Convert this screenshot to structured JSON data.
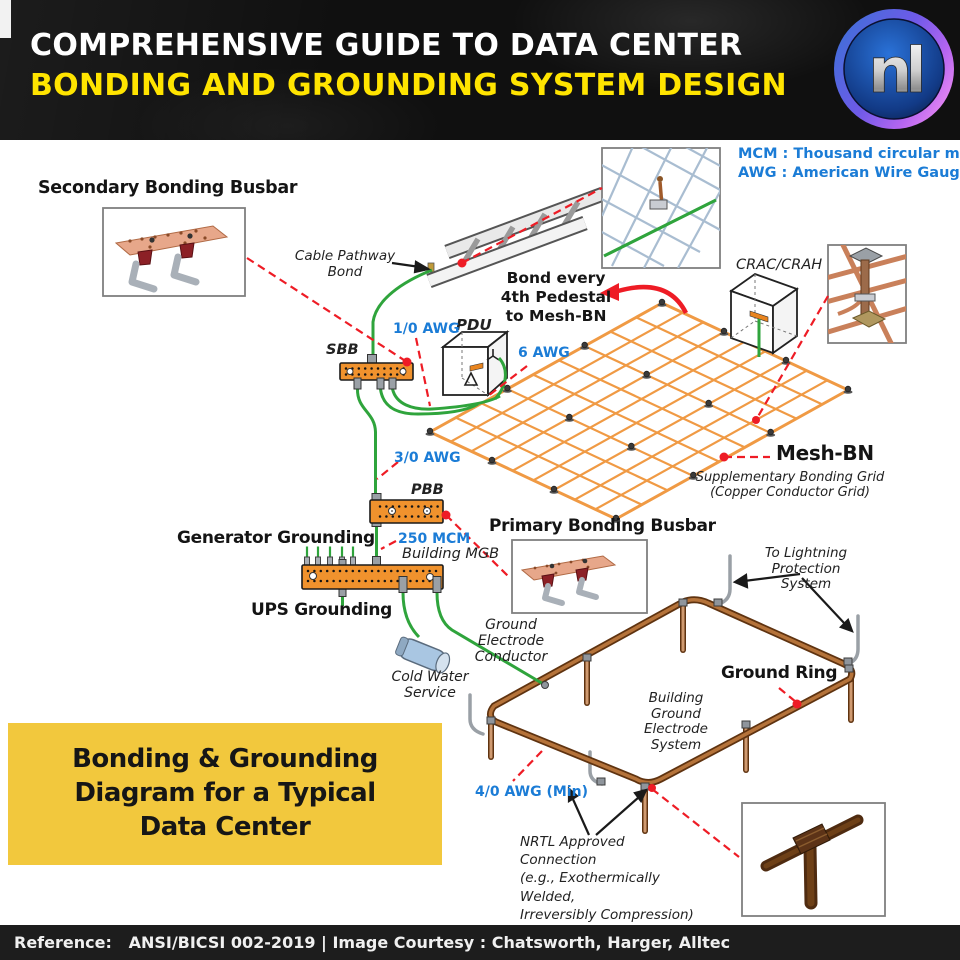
{
  "header": {
    "title_line1": "COMPREHENSIVE GUIDE TO DATA CENTER",
    "title_line2": "BONDING AND GROUNDING SYSTEM DESIGN",
    "logo_text": "nl"
  },
  "legend": {
    "mcm": "MCM : Thousand circular mils",
    "awg": "AWG : American Wire Gauge"
  },
  "labels": {
    "secondary_bonding_busbar": "Secondary Bonding Busbar",
    "cable_pathway_bond": {
      "line1": "Cable Pathway",
      "line2": "Bond"
    },
    "bond_every_pedestal": {
      "line1": "Bond every",
      "line2": "4th Pedestal",
      "line3": "to Mesh-BN"
    },
    "crac_crah": "CRAC/CRAH",
    "pdu": "PDU",
    "sbb": "SBB",
    "pbb": "PBB",
    "building_mgb": "Building MGB",
    "generator_grounding": "Generator Grounding",
    "ups_grounding": "UPS Grounding",
    "primary_bonding_busbar": "Primary Bonding Busbar",
    "mesh_bn": "Mesh-BN",
    "supplementary_grid": {
      "line1": "Supplementary Bonding Grid",
      "line2": "(Copper Conductor Grid)"
    },
    "ground_electrode_conductor": {
      "line1": "Ground Electrode",
      "line2": "Conductor"
    },
    "cold_water_service": {
      "line1": "Cold Water",
      "line2": "Service"
    },
    "to_lightning_protection": {
      "line1": "To Lightning",
      "line2": "Protection System"
    },
    "ground_ring": "Ground Ring",
    "building_ground_electrode": {
      "line1": "Building Ground",
      "line2": "Electrode System"
    },
    "nrtl_connection": {
      "line1": "NRTL Approved Connection",
      "line2": "(e.g., Exothermically Welded,",
      "line3": "Irreversibly Compression)"
    }
  },
  "wire_specs": {
    "awg_1_0": "1/0 AWG",
    "awg_6": "6 AWG",
    "awg_3_0": "3/0 AWG",
    "mcm_250": "250 MCM",
    "awg_4_0": "4/0 AWG (Min)"
  },
  "callout": {
    "line1": "Bonding & Grounding",
    "line2": "Diagram for a Typical",
    "line3": "Data Center"
  },
  "footer": {
    "text": "Reference:   ANSI/BICSI 002-2019 | Image Courtesy : Chatsworth, Harger, Alltec"
  },
  "colors": {
    "title_yellow": "#FFE400",
    "label_blue": "#1B7CD6",
    "mesh_orange": "#F09A44",
    "busbar_orange": "#F0922D",
    "wire_green": "#2FA43C",
    "copper_ring": "#A9672A",
    "callout_red": "#EE1C25",
    "callout_box_yellow": "#F2C83D"
  }
}
